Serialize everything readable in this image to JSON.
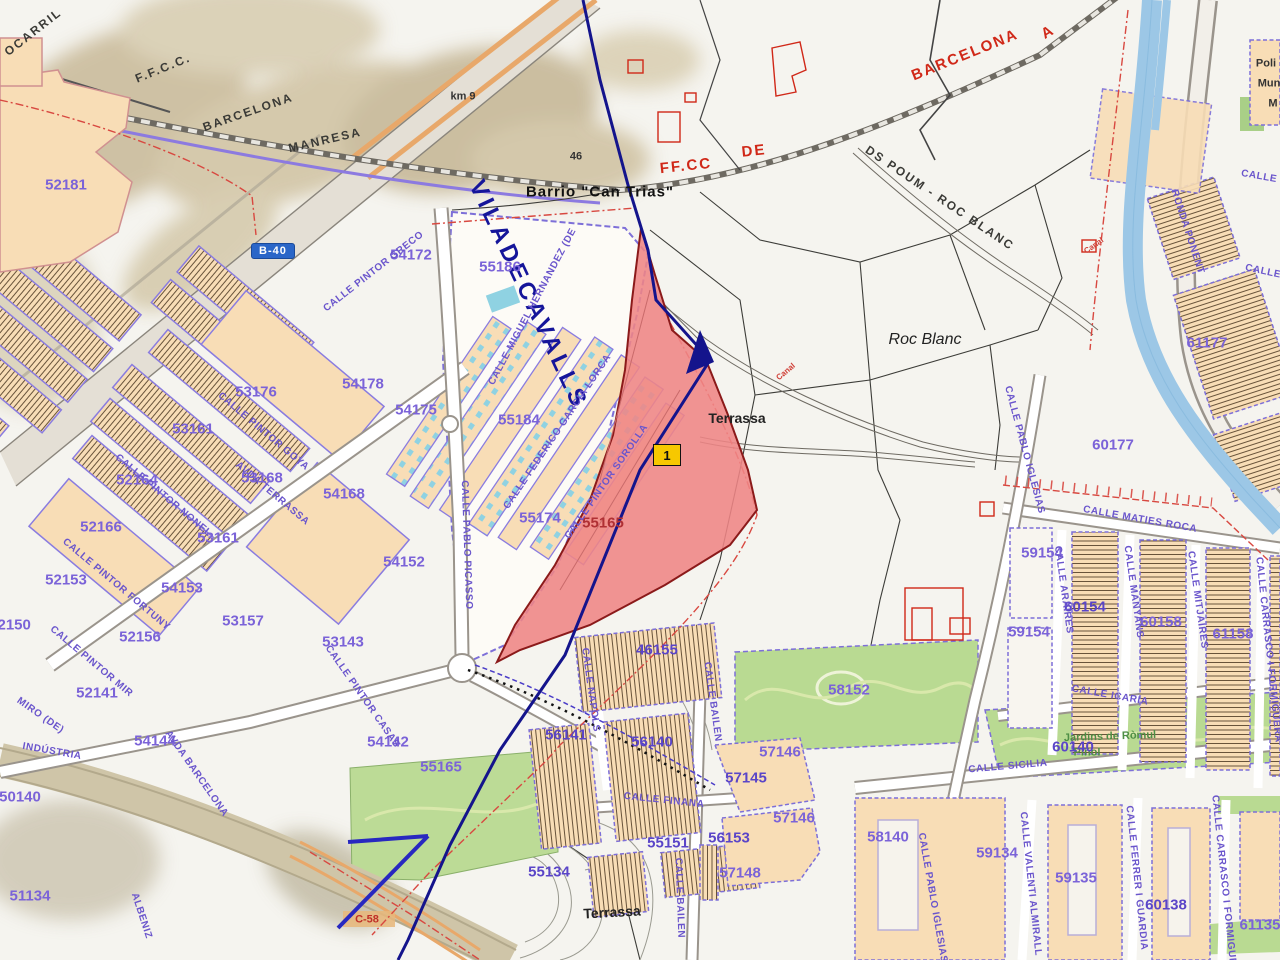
{
  "map": {
    "title": "Cadastral map - Viladecavalls / Terrassa (Can Trias - Roc Blanc)",
    "road_badges": {
      "b40": "B-40"
    },
    "marker": {
      "label": "1"
    },
    "colors": {
      "parcel_number": "#7b63d8",
      "street_name": "#6a55cc",
      "selection_fill": "#ef8585",
      "selection_border": "#8b1a1a",
      "municipal_boundary": "#14148c",
      "river": "#9cc7e6",
      "park": "#b9da92",
      "building_block": "#f8ddb6",
      "red_annotation": "#d02818",
      "marker_yellow": "#f7c800",
      "badge_blue": "#2a66c8"
    },
    "labels": [
      {
        "text": "OCARRIL",
        "x": 33,
        "y": 32,
        "rot": -38,
        "cls": "rail"
      },
      {
        "text": "F.F.C.C.",
        "x": 163,
        "y": 68,
        "rot": -22,
        "cls": "rail"
      },
      {
        "text": "BARCELONA",
        "x": 248,
        "y": 112,
        "rot": -19,
        "cls": "rail"
      },
      {
        "text": "MANRESA",
        "x": 325,
        "y": 140,
        "rot": -13,
        "cls": "rail"
      },
      {
        "text": "km 9",
        "x": 463,
        "y": 97,
        "rot": 0,
        "cls": "small-black"
      },
      {
        "text": "46",
        "x": 576,
        "y": 157,
        "rot": 0,
        "cls": "small-black"
      },
      {
        "text": "Barrio  \"Can  Trias\"",
        "x": 600,
        "y": 192,
        "rot": 0,
        "cls": "place-bold"
      },
      {
        "text": "DS POUM - ROC BLANC",
        "x": 940,
        "y": 198,
        "rot": 34,
        "cls": "rail"
      },
      {
        "text": "Roc Blanc",
        "x": 925,
        "y": 340,
        "rot": 0,
        "cls": "place-italic"
      },
      {
        "text": "Terrassa",
        "x": 737,
        "y": 418,
        "rot": 0,
        "cls": "place"
      },
      {
        "text": "Terrassa",
        "x": 612,
        "y": 912,
        "rot": -3,
        "cls": "place"
      },
      {
        "text": "Poli",
        "x": 1266,
        "y": 64,
        "rot": 0,
        "cls": "small-black"
      },
      {
        "text": "Mun",
        "x": 1269,
        "y": 84,
        "rot": 0,
        "cls": "small-black"
      },
      {
        "text": "M",
        "x": 1273,
        "y": 104,
        "rot": 0,
        "cls": "small-black"
      },
      {
        "text": "FF.CC",
        "x": 686,
        "y": 166,
        "rot": -6,
        "cls": "red-big"
      },
      {
        "text": "DE",
        "x": 754,
        "y": 151,
        "rot": -6,
        "cls": "red-big"
      },
      {
        "text": "BARCELONA",
        "x": 965,
        "y": 55,
        "rot": -22,
        "cls": "red-big"
      },
      {
        "text": "A",
        "x": 1048,
        "y": 32,
        "rot": -30,
        "cls": "red-big"
      },
      {
        "text": "Canal",
        "x": 786,
        "y": 372,
        "rot": -40,
        "cls": "red-tiny"
      },
      {
        "text": "Canal",
        "x": 1094,
        "y": 246,
        "rot": -35,
        "cls": "red-tiny"
      },
      {
        "text": "C-58",
        "x": 367,
        "y": 920,
        "rot": 0,
        "cls": "red-small"
      },
      {
        "text": "VILADECAVALLS",
        "x": 528,
        "y": 295,
        "rot": 65,
        "cls": "muni"
      },
      {
        "text": "Jardins de Ròmul",
        "x": 1110,
        "y": 737,
        "rot": -2,
        "cls": "green"
      },
      {
        "text": "Piñol",
        "x": 1087,
        "y": 753,
        "rot": 0,
        "cls": "green"
      },
      {
        "text": "52181",
        "x": 66,
        "y": 185,
        "rot": 0,
        "cls": "parcel"
      },
      {
        "text": "54172",
        "x": 411,
        "y": 255,
        "rot": 0,
        "cls": "parcel"
      },
      {
        "text": "55186",
        "x": 500,
        "y": 267,
        "rot": 0,
        "cls": "parcel"
      },
      {
        "text": "53176",
        "x": 256,
        "y": 392,
        "rot": 0,
        "cls": "parcel"
      },
      {
        "text": "54178",
        "x": 363,
        "y": 384,
        "rot": 0,
        "cls": "parcel"
      },
      {
        "text": "54175",
        "x": 416,
        "y": 410,
        "rot": 0,
        "cls": "parcel"
      },
      {
        "text": "55184",
        "x": 519,
        "y": 420,
        "rot": 0,
        "cls": "parcel"
      },
      {
        "text": "53161",
        "x": 193,
        "y": 429,
        "rot": 0,
        "cls": "parcel"
      },
      {
        "text": "53168",
        "x": 262,
        "y": 478,
        "rot": 0,
        "cls": "parcel"
      },
      {
        "text": "52164",
        "x": 137,
        "y": 480,
        "rot": 0,
        "cls": "parcel"
      },
      {
        "text": "52166",
        "x": 101,
        "y": 527,
        "rot": 0,
        "cls": "parcel"
      },
      {
        "text": "53161",
        "x": 218,
        "y": 538,
        "rot": 0,
        "cls": "parcel"
      },
      {
        "text": "52153",
        "x": 66,
        "y": 580,
        "rot": 0,
        "cls": "parcel"
      },
      {
        "text": "54153",
        "x": 182,
        "y": 588,
        "rot": 0,
        "cls": "parcel"
      },
      {
        "text": "53157",
        "x": 243,
        "y": 621,
        "rot": 0,
        "cls": "parcel"
      },
      {
        "text": "52156",
        "x": 140,
        "y": 637,
        "rot": 0,
        "cls": "parcel"
      },
      {
        "text": "52150",
        "x": 10,
        "y": 625,
        "rot": 0,
        "cls": "parcel"
      },
      {
        "text": "54168",
        "x": 344,
        "y": 494,
        "rot": 0,
        "cls": "parcel"
      },
      {
        "text": "55174",
        "x": 540,
        "y": 518,
        "rot": 0,
        "cls": "parcel"
      },
      {
        "text": "55165",
        "x": 603,
        "y": 523,
        "rot": 0,
        "cls": "parcel-red"
      },
      {
        "text": "54152",
        "x": 404,
        "y": 562,
        "rot": 0,
        "cls": "parcel"
      },
      {
        "text": "53143",
        "x": 343,
        "y": 642,
        "rot": 0,
        "cls": "parcel"
      },
      {
        "text": "54142",
        "x": 388,
        "y": 742,
        "rot": 0,
        "cls": "parcel"
      },
      {
        "text": "55165",
        "x": 441,
        "y": 767,
        "rot": 0,
        "cls": "parcel"
      },
      {
        "text": "52141",
        "x": 97,
        "y": 693,
        "rot": 0,
        "cls": "parcel"
      },
      {
        "text": "54144",
        "x": 155,
        "y": 741,
        "rot": 0,
        "cls": "parcel"
      },
      {
        "text": "50140",
        "x": 20,
        "y": 797,
        "rot": 0,
        "cls": "parcel"
      },
      {
        "text": "51134",
        "x": 30,
        "y": 896,
        "rot": 0,
        "cls": "parcel"
      },
      {
        "text": "60177",
        "x": 1113,
        "y": 445,
        "rot": 0,
        "cls": "parcel"
      },
      {
        "text": "61177",
        "x": 1207,
        "y": 343,
        "rot": 0,
        "cls": "parcel"
      },
      {
        "text": "59154",
        "x": 1042,
        "y": 553,
        "rot": 0,
        "cls": "parcel"
      },
      {
        "text": "60154",
        "x": 1085,
        "y": 607,
        "rot": 0,
        "cls": "parcel-bold"
      },
      {
        "text": "59154",
        "x": 1029,
        "y": 632,
        "rot": 0,
        "cls": "parcel"
      },
      {
        "text": "60158",
        "x": 1161,
        "y": 622,
        "rot": 0,
        "cls": "parcel"
      },
      {
        "text": "61158",
        "x": 1233,
        "y": 634,
        "rot": 0,
        "cls": "parcel"
      },
      {
        "text": "58152",
        "x": 849,
        "y": 690,
        "rot": 0,
        "cls": "parcel"
      },
      {
        "text": "46155",
        "x": 657,
        "y": 650,
        "rot": 0,
        "cls": "parcel-bold"
      },
      {
        "text": "56141",
        "x": 566,
        "y": 735,
        "rot": 0,
        "cls": "parcel-bold"
      },
      {
        "text": "56140",
        "x": 652,
        "y": 742,
        "rot": 0,
        "cls": "parcel-bold"
      },
      {
        "text": "57146",
        "x": 780,
        "y": 752,
        "rot": 0,
        "cls": "parcel"
      },
      {
        "text": "57145",
        "x": 746,
        "y": 778,
        "rot": 0,
        "cls": "parcel-bold"
      },
      {
        "text": "57146",
        "x": 794,
        "y": 818,
        "rot": 0,
        "cls": "parcel"
      },
      {
        "text": "58140",
        "x": 888,
        "y": 837,
        "rot": 0,
        "cls": "parcel"
      },
      {
        "text": "59134",
        "x": 997,
        "y": 853,
        "rot": 0,
        "cls": "parcel"
      },
      {
        "text": "59135",
        "x": 1076,
        "y": 878,
        "rot": 0,
        "cls": "parcel"
      },
      {
        "text": "60138",
        "x": 1166,
        "y": 905,
        "rot": 0,
        "cls": "parcel-bold"
      },
      {
        "text": "61135",
        "x": 1260,
        "y": 925,
        "rot": 0,
        "cls": "parcel"
      },
      {
        "text": "57148",
        "x": 740,
        "y": 873,
        "rot": 0,
        "cls": "parcel"
      },
      {
        "text": "55134",
        "x": 549,
        "y": 872,
        "rot": 0,
        "cls": "parcel-bold"
      },
      {
        "text": "55151",
        "x": 668,
        "y": 843,
        "rot": 0,
        "cls": "parcel-bold"
      },
      {
        "text": "56153",
        "x": 729,
        "y": 838,
        "rot": 0,
        "cls": "parcel-bold"
      },
      {
        "text": "60140",
        "x": 1073,
        "y": 747,
        "rot": 0,
        "cls": "parcel-bold"
      },
      {
        "text": "CALLE PINTOR GRECO",
        "x": 374,
        "y": 272,
        "rot": -38,
        "cls": "street"
      },
      {
        "text": "CALLE MIGUEL HERNANDEZ (DE",
        "x": 533,
        "y": 307,
        "rot": -62,
        "cls": "street"
      },
      {
        "text": "CALLE FEDERICO GARCIA LORCA",
        "x": 558,
        "y": 432,
        "rot": -56,
        "cls": "street"
      },
      {
        "text": "CALLE PABLO PICASSO",
        "x": 466,
        "y": 545,
        "rot": 88,
        "cls": "street"
      },
      {
        "text": "CALLE PINTOR SOROLLA",
        "x": 607,
        "y": 482,
        "rot": -55,
        "cls": "street"
      },
      {
        "text": "AVDA TERRASSA",
        "x": 272,
        "y": 494,
        "rot": 40,
        "cls": "street"
      },
      {
        "text": "CALLE PINTOR GOYA",
        "x": 263,
        "y": 432,
        "rot": 40,
        "cls": "street"
      },
      {
        "text": "CALLE PINTOR NONEL",
        "x": 163,
        "y": 496,
        "rot": 40,
        "cls": "street"
      },
      {
        "text": "CALLE PINTOR FORTUNY",
        "x": 116,
        "y": 585,
        "rot": 40,
        "cls": "street"
      },
      {
        "text": "CALLE PINTOR MIR",
        "x": 91,
        "y": 662,
        "rot": 40,
        "cls": "street"
      },
      {
        "text": "CALLE PINTOR CASAS",
        "x": 362,
        "y": 697,
        "rot": 55,
        "cls": "street"
      },
      {
        "text": "MIRO (DE)",
        "x": 40,
        "y": 716,
        "rot": 35,
        "cls": "street"
      },
      {
        "text": "INDÚSTRIA",
        "x": 52,
        "y": 752,
        "rot": 10,
        "cls": "street"
      },
      {
        "text": "AVDA BARCELONA",
        "x": 196,
        "y": 774,
        "rot": 55,
        "cls": "street"
      },
      {
        "text": "ALBENIZ",
        "x": 141,
        "y": 916,
        "rot": 72,
        "cls": "street"
      },
      {
        "text": "CALLE NAPOLS",
        "x": 590,
        "y": 690,
        "rot": 82,
        "cls": "street"
      },
      {
        "text": "CALLE BAILEN",
        "x": 712,
        "y": 702,
        "rot": 82,
        "cls": "street"
      },
      {
        "text": "CALLE BAILEN",
        "x": 679,
        "y": 898,
        "rot": 88,
        "cls": "street"
      },
      {
        "text": "CALLE FINANA",
        "x": 664,
        "y": 801,
        "rot": 6,
        "cls": "street"
      },
      {
        "text": "CALLE SICILIA",
        "x": 1008,
        "y": 767,
        "rot": -5,
        "cls": "street"
      },
      {
        "text": "CALLE ICARIA",
        "x": 1110,
        "y": 696,
        "rot": 10,
        "cls": "street"
      },
      {
        "text": "CALLE PABLO IGLESIAS",
        "x": 1024,
        "y": 450,
        "rot": 75,
        "cls": "street"
      },
      {
        "text": "CALLE PABLO IGLESIAS",
        "x": 932,
        "y": 898,
        "rot": 80,
        "cls": "street"
      },
      {
        "text": "CALLE MATIES ROCA",
        "x": 1140,
        "y": 520,
        "rot": 10,
        "cls": "street"
      },
      {
        "text": "CALLE ARAIRES",
        "x": 1063,
        "y": 590,
        "rot": 82,
        "cls": "street"
      },
      {
        "text": "CALLE MANYANS",
        "x": 1133,
        "y": 592,
        "rot": 82,
        "cls": "street"
      },
      {
        "text": "CALLE MITJAIRES",
        "x": 1197,
        "y": 600,
        "rot": 82,
        "cls": "street"
      },
      {
        "text": "CALLE CARRASCO I FORMIGUERA",
        "x": 1268,
        "y": 650,
        "rot": 84,
        "cls": "street"
      },
      {
        "text": "CALLE CARRASCO I FORMIGUERA",
        "x": 1224,
        "y": 888,
        "rot": 84,
        "cls": "street"
      },
      {
        "text": "CALLE VALENTI ALMIRALL",
        "x": 1030,
        "y": 884,
        "rot": 84,
        "cls": "street"
      },
      {
        "text": "CALLE FERRER I GUARDIA",
        "x": 1136,
        "y": 878,
        "rot": 84,
        "cls": "street"
      },
      {
        "text": "RONDA PONENT",
        "x": 1187,
        "y": 232,
        "rot": 72,
        "cls": "street"
      },
      {
        "text": "CALLE",
        "x": 1259,
        "y": 177,
        "rot": 10,
        "cls": "street"
      },
      {
        "text": "CALLE",
        "x": 1263,
        "y": 272,
        "rot": 12,
        "cls": "street"
      }
    ]
  }
}
